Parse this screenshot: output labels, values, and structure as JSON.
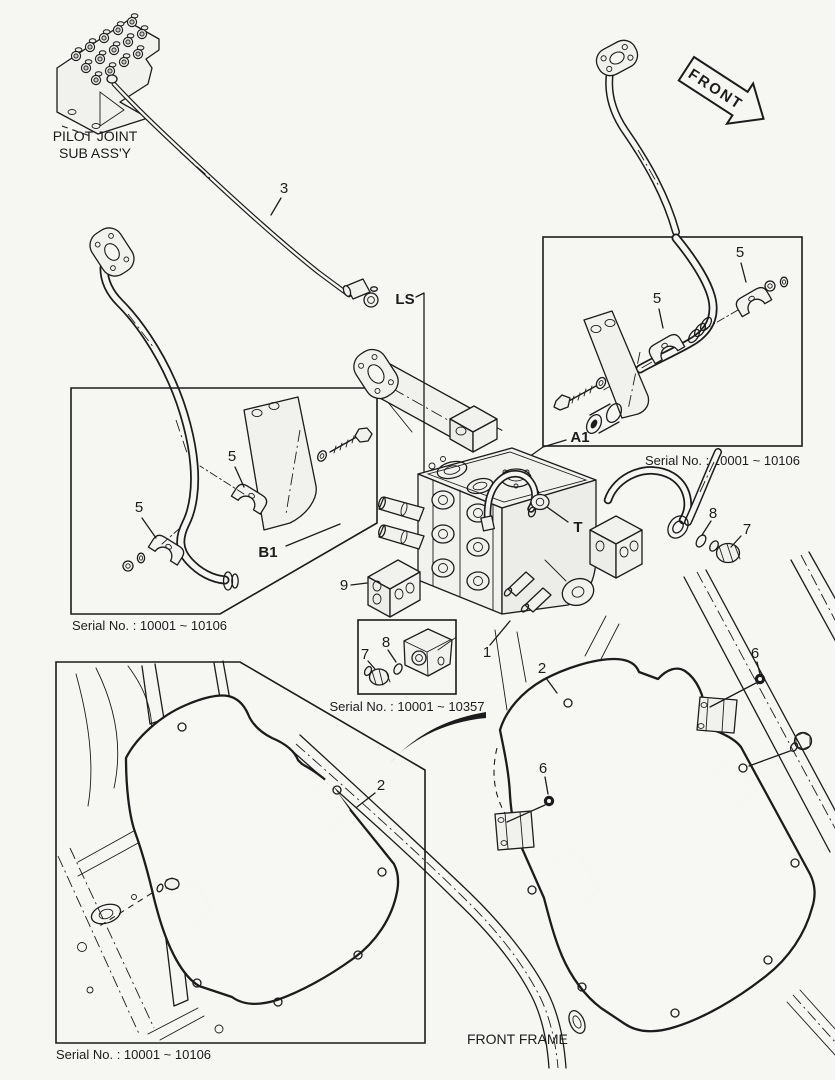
{
  "page": {
    "background": "#f6f6f3",
    "line_color": "#1c1c1c"
  },
  "labels": {
    "pilot_joint_line1": "PILOT JOINT",
    "pilot_joint_line2": "SUB ASS'Y",
    "front_arrow": "FRONT",
    "front_frame": "FRONT FRAME",
    "port_ls": "LS",
    "port_t": "T",
    "ref_a1": "A1",
    "ref_b1": "B1"
  },
  "serial_notes": {
    "a1_box": "Serial No. : 10001 ~ 10106",
    "b1_box": "Serial No. : 10001 ~ 10106",
    "plug_box": "Serial No. : 10001 ~ 10357",
    "cover_box": "Serial No. : 10001 ~ 10106"
  },
  "callouts": [
    {
      "num": "3"
    },
    {
      "num": "5"
    },
    {
      "num": "5"
    },
    {
      "num": "5"
    },
    {
      "num": "5"
    },
    {
      "num": "9"
    },
    {
      "num": "8"
    },
    {
      "num": "7"
    },
    {
      "num": "1"
    },
    {
      "num": "8"
    },
    {
      "num": "7"
    },
    {
      "num": "2"
    },
    {
      "num": "6"
    },
    {
      "num": "6"
    },
    {
      "num": "2"
    }
  ]
}
